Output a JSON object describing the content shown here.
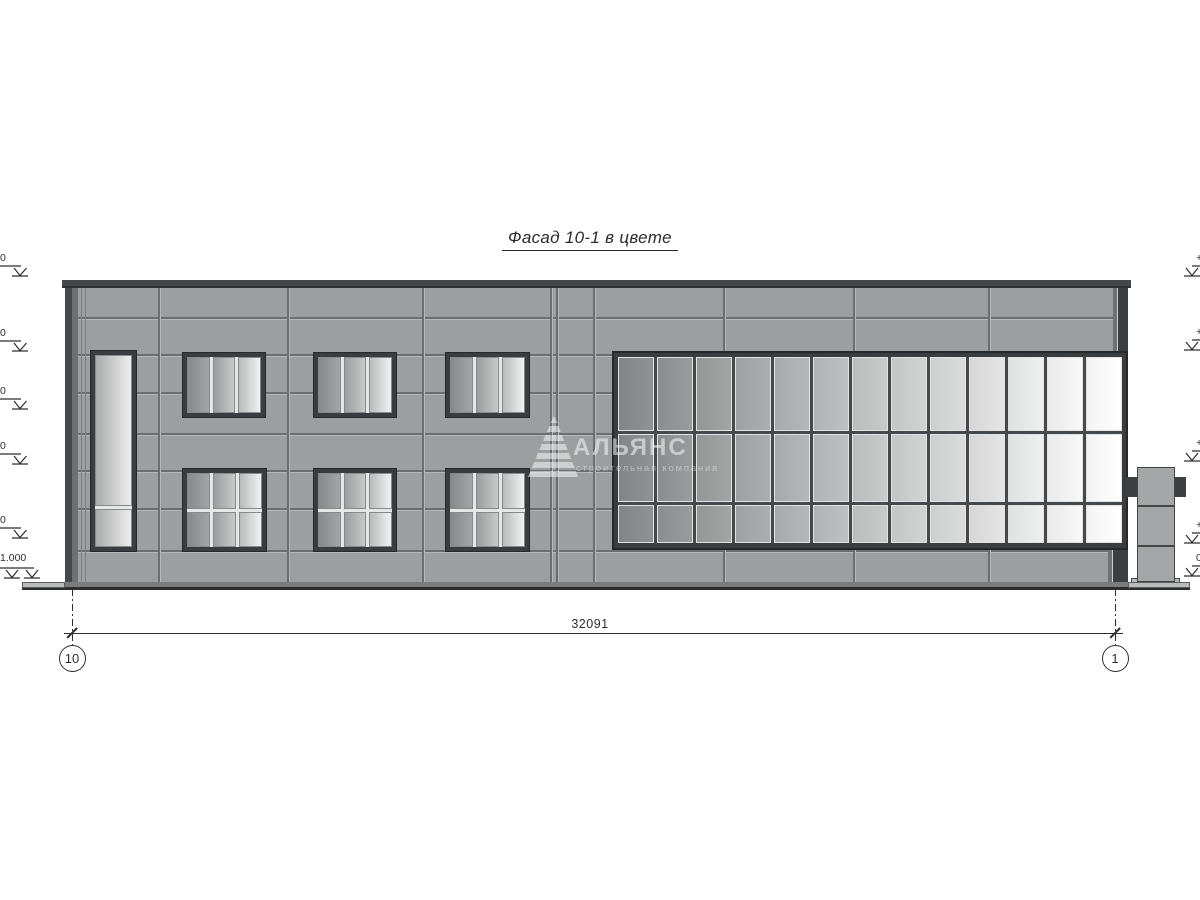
{
  "title": "Фасад 10-1 в цвете",
  "watermark": {
    "logo": "alliance-triangle-icon",
    "name": "АЛЬЯНС",
    "tagline": "строительная компания"
  },
  "dimension_label": "32091",
  "grid_axes": [
    {
      "label": "10",
      "x": 72
    },
    {
      "label": "1",
      "x": 1115
    }
  ],
  "dimension_line": {
    "y": 633,
    "x1": 64,
    "x2": 1123,
    "tick1": 72,
    "tick2": 1115,
    "ext_top": 589,
    "ext_bottom": 646
  },
  "elevation_marks": {
    "left": [
      {
        "y": 278,
        "text": "0"
      },
      {
        "y": 353,
        "text": "0"
      },
      {
        "y": 411,
        "text": "0"
      },
      {
        "y": 466,
        "text": "0"
      },
      {
        "y": 540,
        "text": "0"
      },
      {
        "y": 580,
        "text": "1.000",
        "double": true
      }
    ],
    "right": [
      {
        "y": 278,
        "text": "+"
      },
      {
        "y": 352,
        "text": "+"
      },
      {
        "y": 463,
        "text": "+"
      },
      {
        "y": 545,
        "text": "+"
      },
      {
        "y": 578,
        "text": "0"
      }
    ]
  },
  "colors": {
    "wall": "#9c9e9f",
    "joint": "#6b6d6e",
    "joint_hi": "#b5b7b8",
    "joint_thin": "#7c7e7f",
    "parapet": "#45484b",
    "parapet_edge": "#2f3234",
    "frame_dark": "#3a3d3f",
    "frame_outline": "#26282a",
    "frame_light": "#e6e7e7",
    "pane_border": "#85878.8",
    "curtain_area": "#46494c",
    "curtain_pane_border": "#e2e2e2",
    "plinth": "#7a7c7d",
    "apron": "#b9bbbc",
    "line": "#2e2e2e",
    "pylon": "#a4a6a7",
    "pylon_border": "#44474a",
    "tab": "#3d4043"
  },
  "facade": {
    "wall": {
      "x": 65,
      "y": 288,
      "w": 1063,
      "h": 295
    },
    "parapet": {
      "x": 62,
      "y": 280,
      "w": 1069,
      "h": 8
    },
    "plinth": {
      "x": 65,
      "y": 582,
      "w": 1063,
      "h": 6
    },
    "aprons": [
      {
        "x": 22,
        "y": 582,
        "w": 43,
        "h": 6
      },
      {
        "x": 1128,
        "y": 582,
        "w": 62,
        "h": 6
      }
    ],
    "ground": {
      "x1": 22,
      "x2": 1190,
      "y": 588
    },
    "h_joints": [
      317,
      354,
      392,
      433,
      470,
      508,
      550
    ],
    "v_joints": [
      158,
      287,
      422,
      550,
      556,
      593,
      723,
      853,
      988
    ],
    "v_joints_thin": [
      81,
      85
    ],
    "corner_trims": [
      {
        "x": 65,
        "y": 288,
        "w": 13,
        "h": 295,
        "style": "left"
      },
      {
        "x": 1113,
        "y": 288,
        "w": 15,
        "h": 64,
        "style": "right"
      },
      {
        "x": 1108,
        "y": 550,
        "w": 20,
        "h": 33,
        "style": "right"
      }
    ],
    "windows": [
      {
        "x": 90,
        "y": 350,
        "w": 47,
        "h": 202,
        "cols": 1,
        "rows": [
          0.8,
          0.2
        ]
      },
      {
        "x": 182,
        "y": 352,
        "w": 84,
        "h": 66,
        "cols": 3,
        "rows": [
          1
        ]
      },
      {
        "x": 313,
        "y": 352,
        "w": 84,
        "h": 66,
        "cols": 3,
        "rows": [
          1
        ]
      },
      {
        "x": 445,
        "y": 352,
        "w": 85,
        "h": 66,
        "cols": 3,
        "rows": [
          1
        ]
      },
      {
        "x": 182,
        "y": 468,
        "w": 85,
        "h": 84,
        "cols": 3,
        "rows": [
          0.5,
          0.5
        ]
      },
      {
        "x": 313,
        "y": 468,
        "w": 84,
        "h": 84,
        "cols": 3,
        "rows": [
          0.5,
          0.5
        ]
      },
      {
        "x": 445,
        "y": 468,
        "w": 85,
        "h": 84,
        "cols": 3,
        "rows": [
          0.5,
          0.5
        ]
      }
    ],
    "window_col_colors": {
      "1": [
        [
          "#a9abac",
          "#eeeeee"
        ]
      ],
      "3": [
        [
          "#87898a",
          "#a3a5a6"
        ],
        [
          "#9b9d9e",
          "#c8caca"
        ],
        [
          "#b9bbbc",
          "#f1f1f1"
        ]
      ]
    },
    "curtain_wall": {
      "x": 612,
      "y": 351,
      "w": 516,
      "h": 199,
      "cols": 13,
      "row_fracs": [
        0.41,
        0.38,
        0.21
      ],
      "glass_from": [
        137,
        139,
        140
      ],
      "glass_to": [
        250,
        250,
        250
      ]
    },
    "pylon": {
      "x": 1137,
      "y": 467,
      "w": 38,
      "h": 115,
      "joints": [
        505,
        545
      ],
      "tabs": [
        {
          "x": 1126,
          "y": 477,
          "w": 11,
          "h": 20
        },
        {
          "x": 1175,
          "y": 477,
          "w": 11,
          "h": 20
        }
      ],
      "base": {
        "x": 1131,
        "y": 578,
        "w": 49,
        "h": 9
      }
    }
  }
}
